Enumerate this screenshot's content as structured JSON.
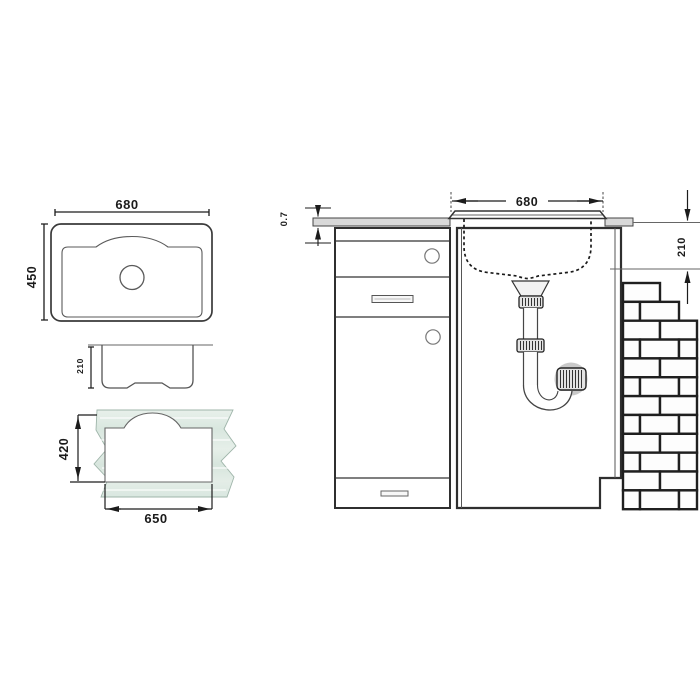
{
  "dims": {
    "top_view": {
      "width": "680",
      "depth": "450"
    },
    "side_view": {
      "bowl_height": "210"
    },
    "template": {
      "cutout_depth": "420",
      "cutout_width": "650"
    },
    "installation": {
      "sink_width": "680",
      "worktop_thickness": "0.7",
      "bowl_depth": "210"
    }
  },
  "colors": {
    "line": "#2f2f2f",
    "thin_line": "#555555",
    "dim_line": "#1c1c1c",
    "worktop_fill": "#d9d9d9",
    "template_fill_light": "#e8f0eb",
    "template_fill_dark": "#d8e6de",
    "brick_joint": "#1f1f1f",
    "brick_fill": "#fdfdfd",
    "metal_fill": "#e3e3e3",
    "halo_fill": "#c9c9c9"
  }
}
